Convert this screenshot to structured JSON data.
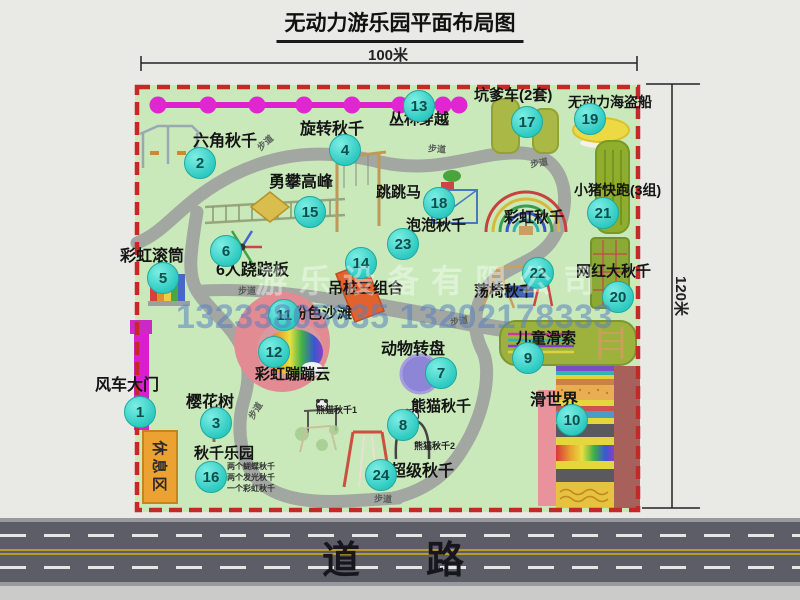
{
  "title": "无动力游乐园平面布局图",
  "dim_top_label": "100米",
  "dim_right_label": "120米",
  "road_label": "道　路",
  "rest_area_label": "休息区",
  "watermark": {
    "company": "游乐设备有限公司",
    "phone": "13233805635 13202178333"
  },
  "colors": {
    "map_bg": "#c9e9bb",
    "boundary": "#c62828",
    "marker": "#2cc9c0",
    "road": "#5d5d67",
    "chain": "#dd22cc",
    "rest_area": "#eca233"
  },
  "attractions": [
    {
      "num": "1",
      "name": "风车大门",
      "mx": 139,
      "my": 411,
      "lx": 95,
      "ly": 377,
      "fs": 16
    },
    {
      "num": "2",
      "name": "六角秋千",
      "mx": 199,
      "my": 162,
      "lx": 193,
      "ly": 133,
      "fs": 16
    },
    {
      "num": "3",
      "name": "樱花树",
      "mx": 215,
      "my": 422,
      "lx": 186,
      "ly": 394,
      "fs": 16
    },
    {
      "num": "4",
      "name": "旋转秋千",
      "mx": 344,
      "my": 149,
      "lx": 300,
      "ly": 121,
      "fs": 16
    },
    {
      "num": "5",
      "name": "彩虹滚筒",
      "mx": 162,
      "my": 277,
      "lx": 120,
      "ly": 248,
      "fs": 16
    },
    {
      "num": "6",
      "name": "6人跷跷板",
      "mx": 225,
      "my": 250,
      "lx": 216,
      "ly": 262,
      "fs": 16
    },
    {
      "num": "7",
      "name": "动物转盘",
      "mx": 440,
      "my": 372,
      "lx": 381,
      "ly": 341,
      "fs": 16
    },
    {
      "num": "8",
      "name": "熊猫秋千",
      "mx": 402,
      "my": 424,
      "lx": 411,
      "ly": 399,
      "fs": 15
    },
    {
      "num": "9",
      "name": "儿童滑索",
      "mx": 527,
      "my": 357,
      "lx": 516,
      "ly": 331,
      "fs": 15
    },
    {
      "num": "10",
      "name": "滑世界",
      "mx": 571,
      "my": 419,
      "lx": 530,
      "ly": 392,
      "fs": 16
    },
    {
      "num": "11",
      "name": "粉色沙滩",
      "mx": 283,
      "my": 314,
      "lx": 292,
      "ly": 306,
      "fs": 15
    },
    {
      "num": "12",
      "name": "彩虹蹦蹦云",
      "mx": 273,
      "my": 351,
      "lx": 255,
      "ly": 367,
      "fs": 15
    },
    {
      "num": "13",
      "name": "丛林穿越",
      "mx": 418,
      "my": 105,
      "lx": 389,
      "ly": 112,
      "fs": 15
    },
    {
      "num": "14",
      "name": "吊桩三组合",
      "mx": 360,
      "my": 262,
      "lx": 328,
      "ly": 281,
      "fs": 15
    },
    {
      "num": "15",
      "name": "勇攀高峰",
      "mx": 309,
      "my": 211,
      "lx": 269,
      "ly": 174,
      "fs": 16
    },
    {
      "num": "16",
      "name": "秋千乐园",
      "mx": 210,
      "my": 476,
      "lx": 194,
      "ly": 446,
      "fs": 15
    },
    {
      "num": "17",
      "name": "坑爹车(2套)",
      "mx": 526,
      "my": 121,
      "lx": 474,
      "ly": 88,
      "fs": 15
    },
    {
      "num": "18",
      "name": "跳跳马",
      "mx": 438,
      "my": 202,
      "lx": 376,
      "ly": 185,
      "fs": 15
    },
    {
      "num": "19",
      "name": "无动力海盗船",
      "mx": 589,
      "my": 118,
      "lx": 568,
      "ly": 95,
      "fs": 14
    },
    {
      "num": "20",
      "name": "网红大秋千",
      "mx": 617,
      "my": 296,
      "lx": 576,
      "ly": 264,
      "fs": 15
    },
    {
      "num": "21",
      "name": "小猪快跑(3组)",
      "mx": 602,
      "my": 212,
      "lx": 574,
      "ly": 183,
      "fs": 14
    },
    {
      "num": "22",
      "name": "荡椅秋千",
      "mx": 537,
      "my": 272,
      "lx": 474,
      "ly": 284,
      "fs": 15
    },
    {
      "num": "23",
      "name": "泡泡秋千",
      "mx": 402,
      "my": 243,
      "lx": 406,
      "ly": 218,
      "fs": 15
    },
    {
      "num": "24",
      "name": "超级秋千",
      "mx": 380,
      "my": 474,
      "lx": 390,
      "ly": 463,
      "fs": 16
    },
    {
      "num": null,
      "name": "彩虹秋千",
      "mx": null,
      "my": null,
      "lx": 504,
      "ly": 210,
      "fs": 15
    }
  ],
  "path_labels": [
    {
      "text": "步道",
      "x": 256,
      "y": 136,
      "rot": -42
    },
    {
      "text": "步道",
      "x": 428,
      "y": 142,
      "rot": 4
    },
    {
      "text": "步道",
      "x": 530,
      "y": 156,
      "rot": -10
    },
    {
      "text": "步道",
      "x": 238,
      "y": 284,
      "rot": 0
    },
    {
      "text": "步道",
      "x": 450,
      "y": 314,
      "rot": -8
    },
    {
      "text": "步道",
      "x": 246,
      "y": 404,
      "rot": -58
    },
    {
      "text": "步道",
      "x": 374,
      "y": 492,
      "rot": 2
    }
  ],
  "notes": [
    {
      "text": "熊猫秋千1",
      "x": 316,
      "y": 403
    },
    {
      "text": "熊猫秋千2",
      "x": 414,
      "y": 439
    }
  ],
  "swing_note_lines": [
    "两个蝴蝶秋千",
    "两个发光秋千",
    "一个彩虹秋千"
  ]
}
